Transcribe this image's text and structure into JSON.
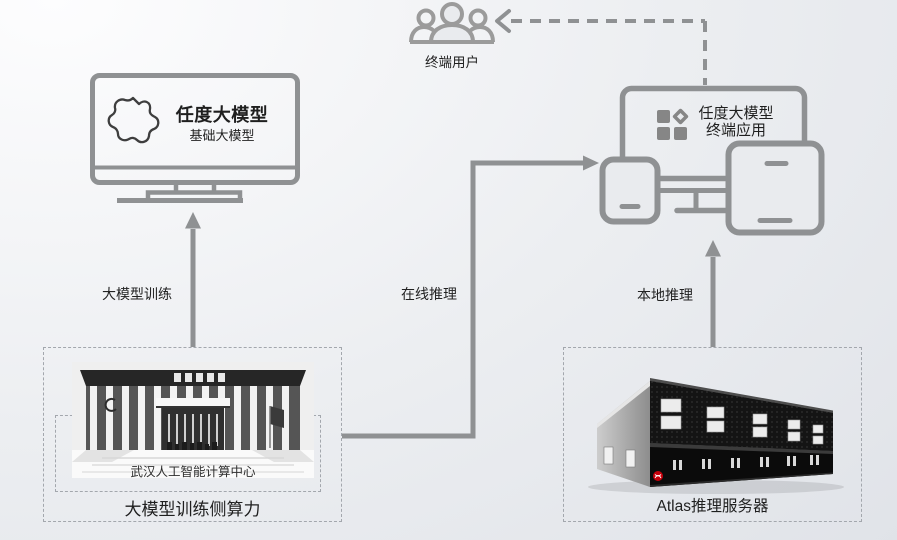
{
  "colors": {
    "line_gray": "#8f9193",
    "icon_gray": "#9b9b9b",
    "text_dark": "#1f1f1f",
    "dash_border": "#a3a7ad",
    "huawei_red": "#c7000b"
  },
  "end_user": {
    "label": "终端用户"
  },
  "base_model_monitor": {
    "title": "任度大模型",
    "subtitle": "基础大模型"
  },
  "terminal_app": {
    "line1": "任度大模型",
    "line2": "终端应用"
  },
  "flow_labels": {
    "training": "大模型训练",
    "online_inference": "在线推理",
    "local_inference": "本地推理"
  },
  "training_side": {
    "photo_caption": "武汉人工智能计算中心",
    "label": "大模型训练侧算力"
  },
  "inference_side": {
    "label": "Atlas推理服务器"
  }
}
